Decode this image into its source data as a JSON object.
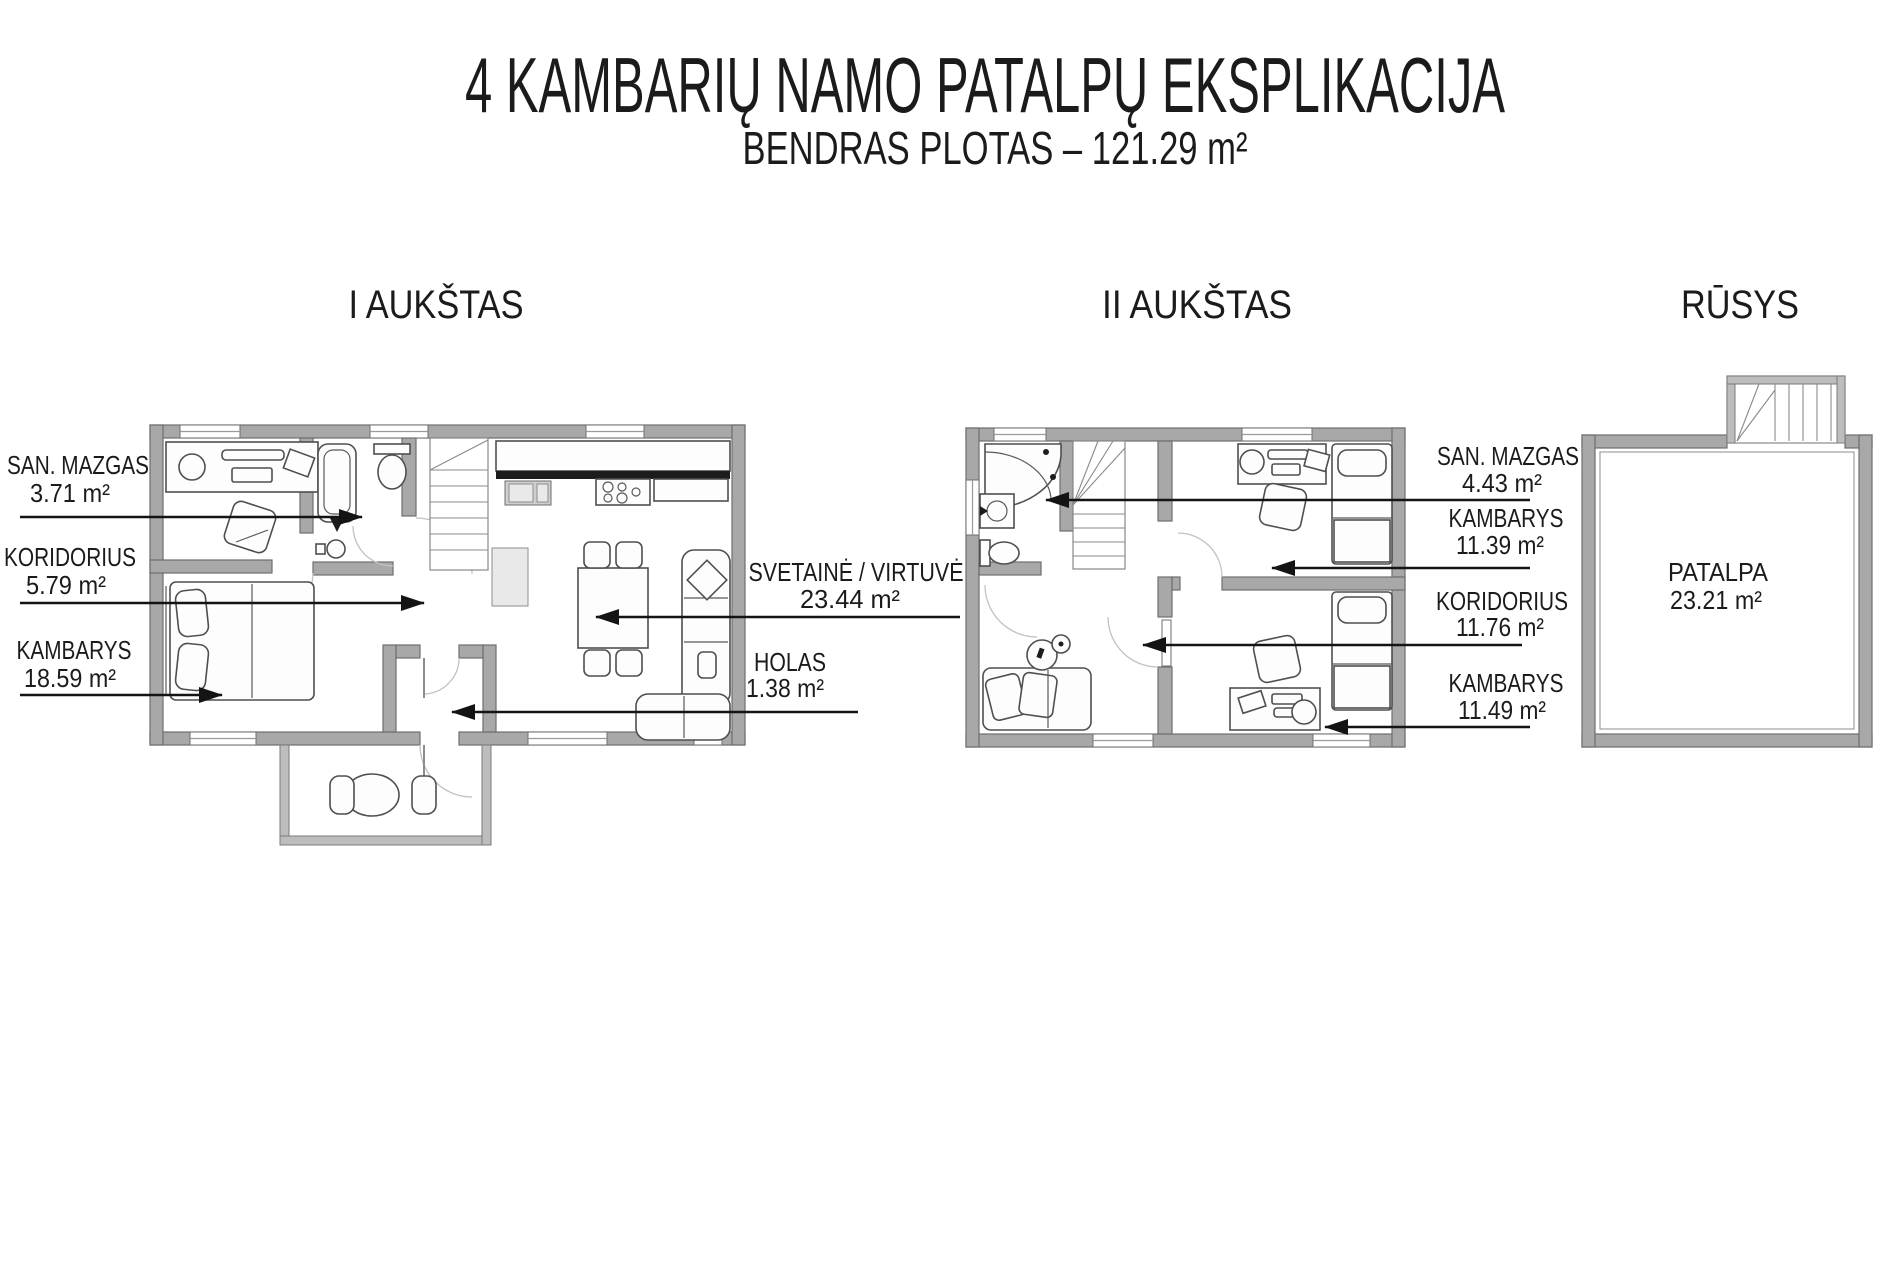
{
  "page": {
    "title": "4 KAMBARIŲ NAMO PATALPŲ EKSPLIKACIJA",
    "subtitle": "BENDRAS PLOTAS – 121.29 m²"
  },
  "floors": [
    {
      "name": "I AUKŠTAS",
      "rooms": [
        {
          "label": "SAN. MAZGAS",
          "area": "3.71 m²"
        },
        {
          "label": "KORIDORIUS",
          "area": "5.79 m²"
        },
        {
          "label": "KAMBARYS",
          "area": "18.59 m²"
        },
        {
          "label": "SVETAINĖ / VIRTUVĖ",
          "area": "23.44  m²"
        },
        {
          "label": "HOLAS",
          "area": "1.38 m²"
        }
      ]
    },
    {
      "name": "II AUKŠTAS",
      "rooms": [
        {
          "label": "SAN. MAZGAS",
          "area": "4.43 m²"
        },
        {
          "label": "KAMBARYS",
          "area": "11.39 m²"
        },
        {
          "label": "KORIDORIUS",
          "area": "11.76 m²"
        },
        {
          "label": "KAMBARYS",
          "area": "11.49 m²"
        }
      ]
    },
    {
      "name": "RŪSYS",
      "rooms": [
        {
          "label": "PATALPA",
          "area": "23.21 m²"
        }
      ]
    }
  ],
  "colors": {
    "wall": "#a8a8a8",
    "wall_outline": "#6e6e6e",
    "text": "#1b1b1b",
    "leader": "#141414",
    "background": "#ffffff"
  }
}
